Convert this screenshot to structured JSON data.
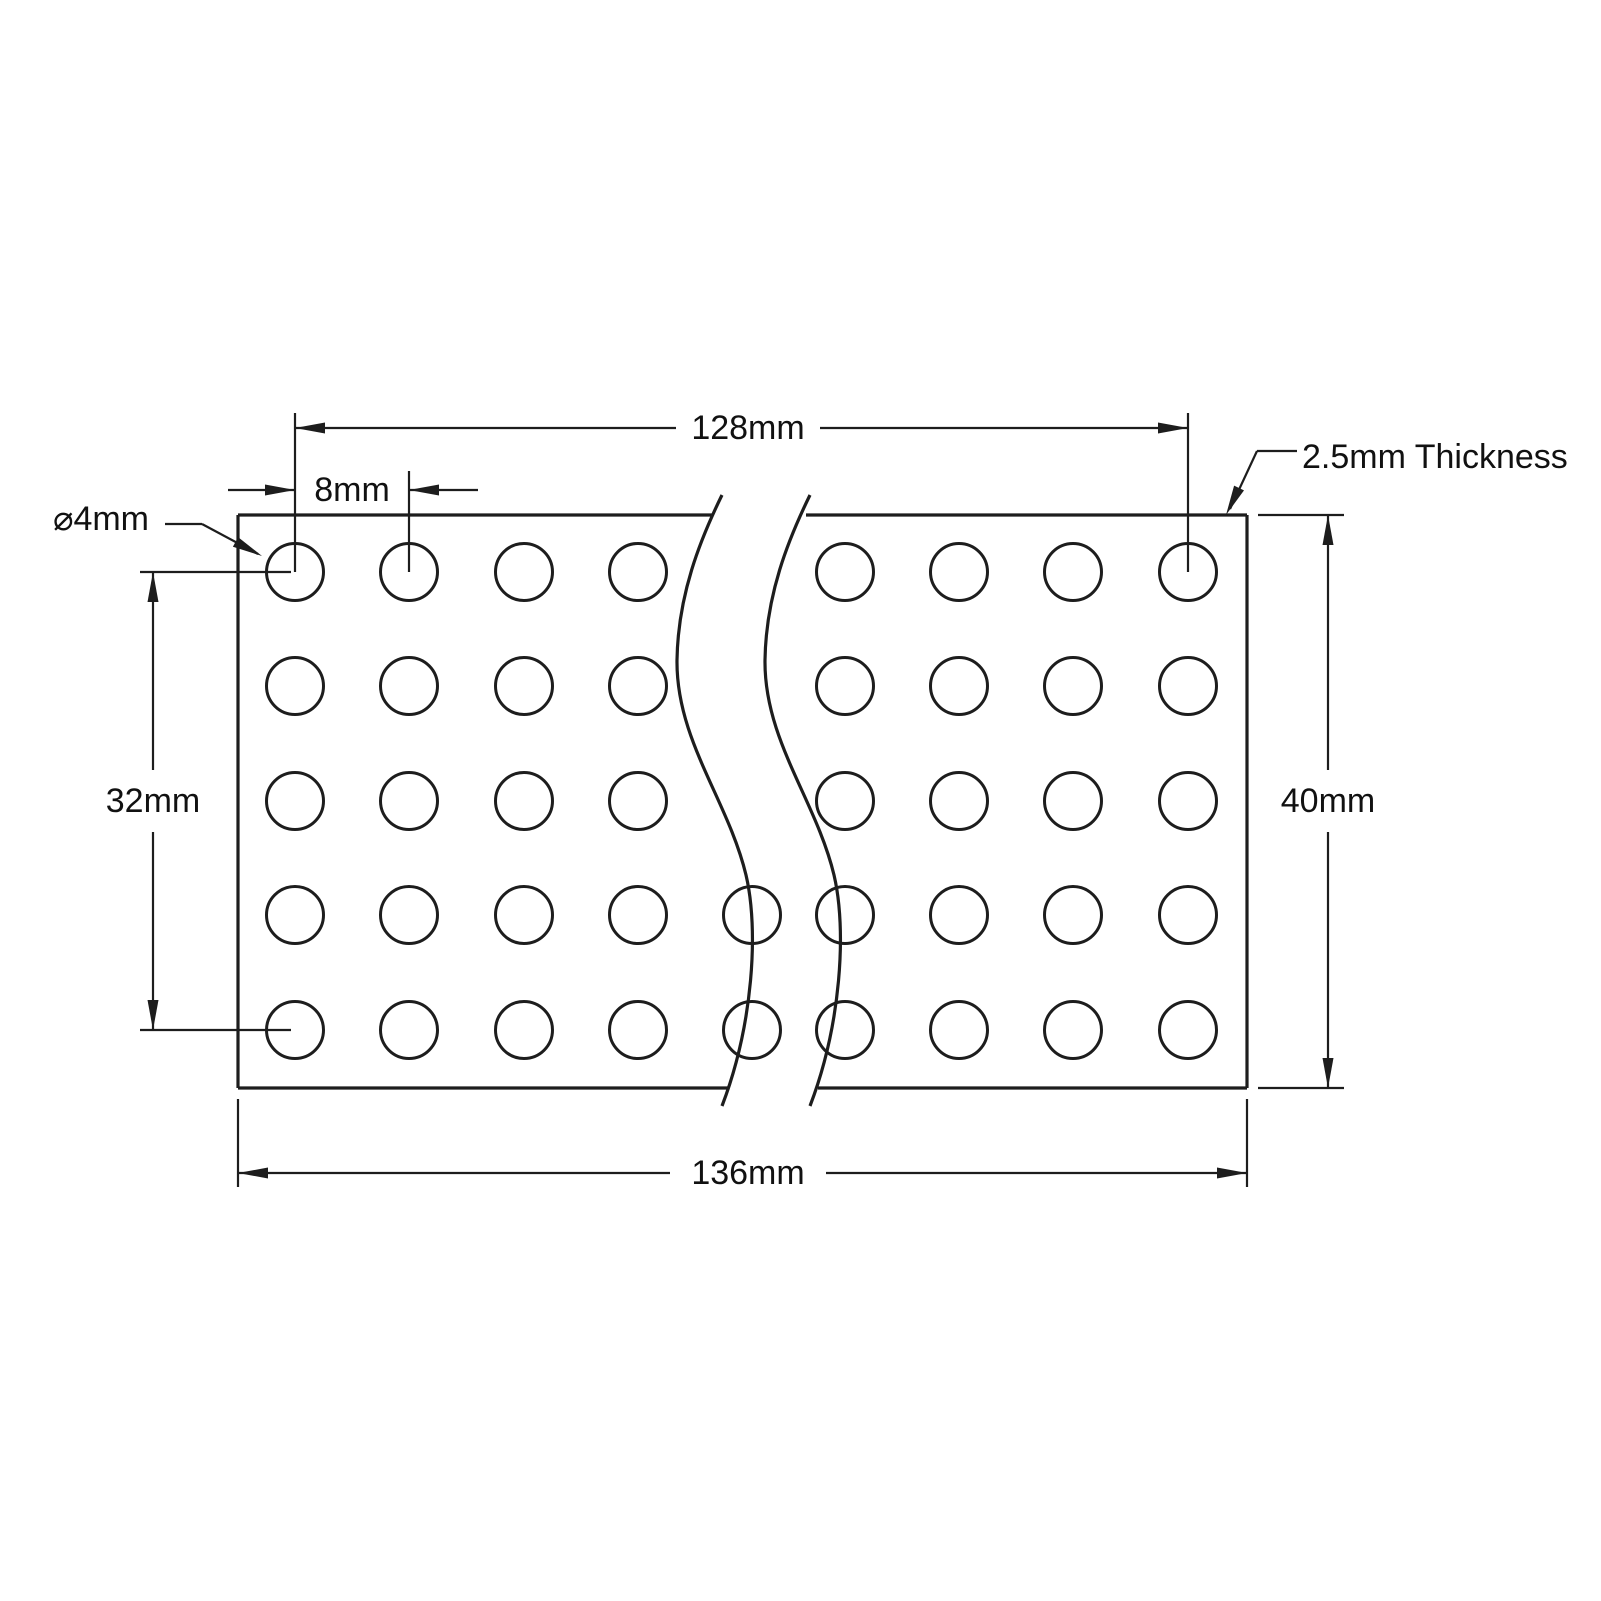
{
  "page": {
    "background": "#ffffff"
  },
  "drawing": {
    "type": "engineering-dimension-drawing",
    "subject": "perforated grid pattern plate shown with break lines",
    "line_color": "#1d1d1d",
    "labels": {
      "overall_hole_span": "128mm",
      "hole_pitch": "8mm",
      "hole_diameter": "⌀4mm",
      "row_span": "32mm",
      "plate_height": "40mm",
      "plate_length": "136mm",
      "thickness": "2.5mm Thickness"
    },
    "hole_grid": {
      "rows": 5,
      "full_columns_shown": 8,
      "partial_columns_shown": 2
    }
  }
}
